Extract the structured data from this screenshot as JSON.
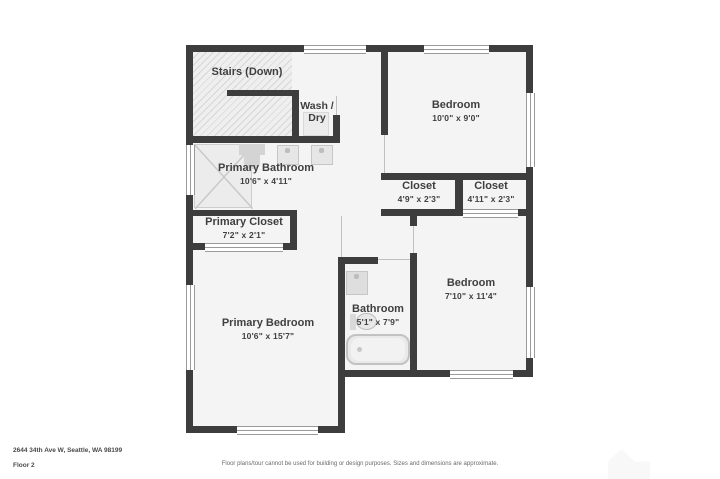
{
  "meta": {
    "address": "2644 34th Ave W, Seattle, WA 98199",
    "floor_label": "Floor 2",
    "disclaimer": "Floor plans/tour cannot be used for building or design purposes. Sizes and dimensions are approximate."
  },
  "rooms": {
    "stairs": {
      "label": "Stairs (Down)"
    },
    "wash_dry": {
      "label": "Wash / Dry"
    },
    "primary_bathroom": {
      "label": "Primary Bathroom",
      "dims": "10'6\" x 4'11\""
    },
    "primary_closet": {
      "label": "Primary Closet",
      "dims": "7'2\" x 2'1\""
    },
    "primary_bedroom": {
      "label": "Primary Bedroom",
      "dims": "10'6\" x 15'7\""
    },
    "bedroom_top_right": {
      "label": "Bedroom",
      "dims": "10'0\" x 9'0\""
    },
    "closet_left": {
      "label": "Closet",
      "dims": "4'9\" x 2'3\""
    },
    "closet_right": {
      "label": "Closet",
      "dims": "4'11\" x 2'3\""
    },
    "bedroom_bottom_right": {
      "label": "Bedroom",
      "dims": "7'10\" x 11'4\""
    },
    "bathroom": {
      "label": "Bathroom",
      "dims": "5'1\" x 7'9\""
    }
  },
  "colors": {
    "wall": "#3d3d3d",
    "room_fill": "#f4f4f4",
    "label_text": "#3f3f3f"
  }
}
